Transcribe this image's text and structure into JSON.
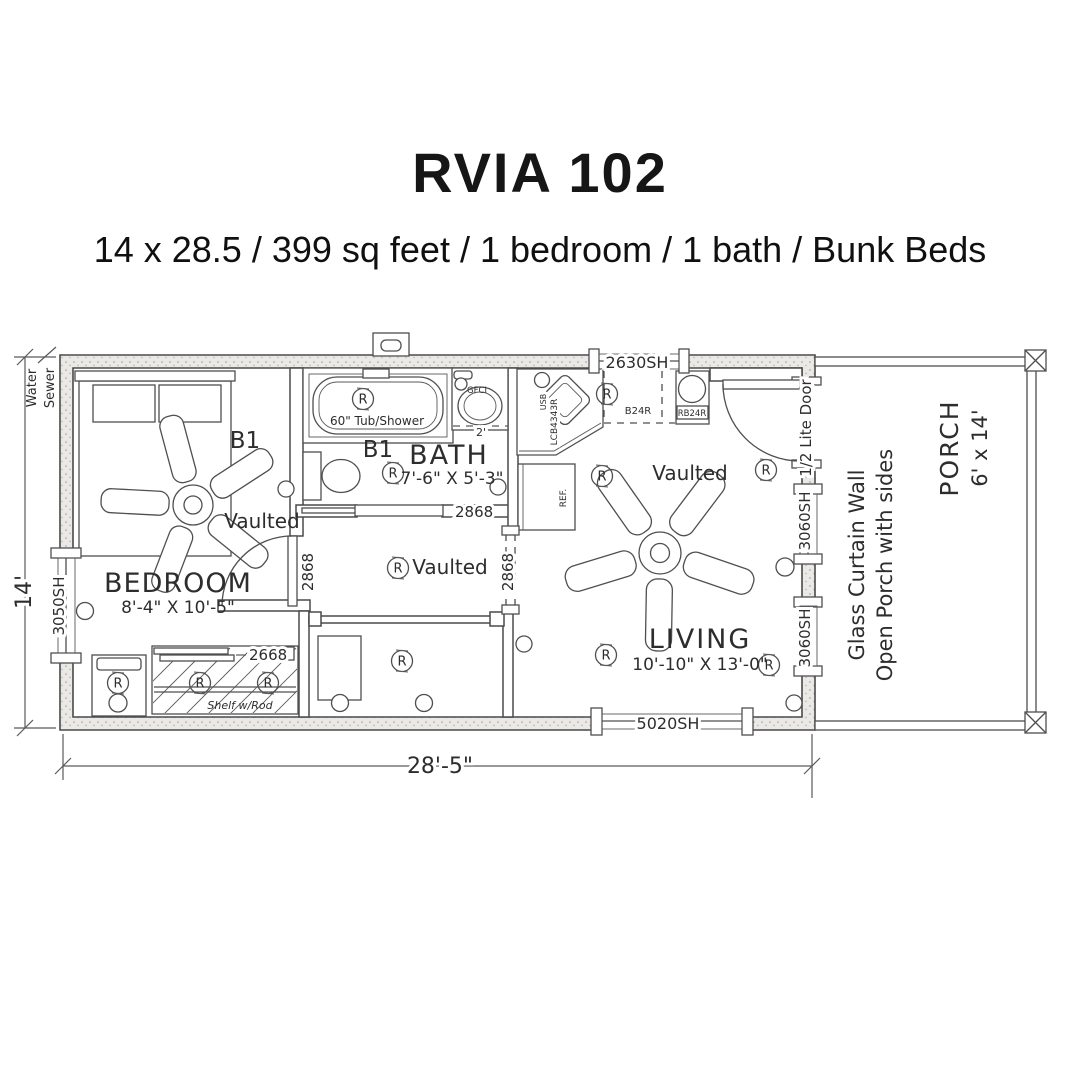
{
  "header": {
    "title": "RVIA 102",
    "subtitle": "14 x 28.5 / 399 sq feet / 1 bedroom / 1 bath / Bunk Beds"
  },
  "plan": {
    "dim_width": "28'-5\"",
    "dim_height": "14'",
    "water": "Water",
    "sewer": "Sewer",
    "receptacle": "R",
    "bedroom": {
      "name": "BEDROOM",
      "dims": "8'-4\" X 10'-5\"",
      "vaulted": "Vaulted",
      "bunk": "B1",
      "window": "3050SH",
      "door": "2868",
      "closet_door": "2668",
      "closet_shelf": "Shelf w/Rod"
    },
    "bath": {
      "name": "BATH",
      "dims": "7'-6\" X 5'-3\"",
      "bunk": "B1",
      "tub": "60\" Tub/Shower",
      "gfci": "GFCI",
      "door": "2868",
      "clearance": "2'"
    },
    "hall": {
      "vaulted": "Vaulted",
      "opening": "2868"
    },
    "kitchen": {
      "window": "2630SH",
      "base_cabinet": "B24R",
      "range": "RB24R",
      "corner_cabinet": "LCB4343R",
      "usb": "USB",
      "fridge": "REF."
    },
    "living": {
      "name": "LIVING",
      "dims": "10'-10\" X 13'-0\"",
      "vaulted": "Vaulted",
      "window_bottom": "5020SH",
      "window_right_upper": "3060SH",
      "window_right_lower": "3060SH",
      "entry_door": "1/2 Lite Door"
    },
    "porch": {
      "name": "PORCH",
      "dims": "6' x 14'",
      "note1": "Glass Curtain Wall",
      "note2": "Open Porch with sides"
    }
  }
}
